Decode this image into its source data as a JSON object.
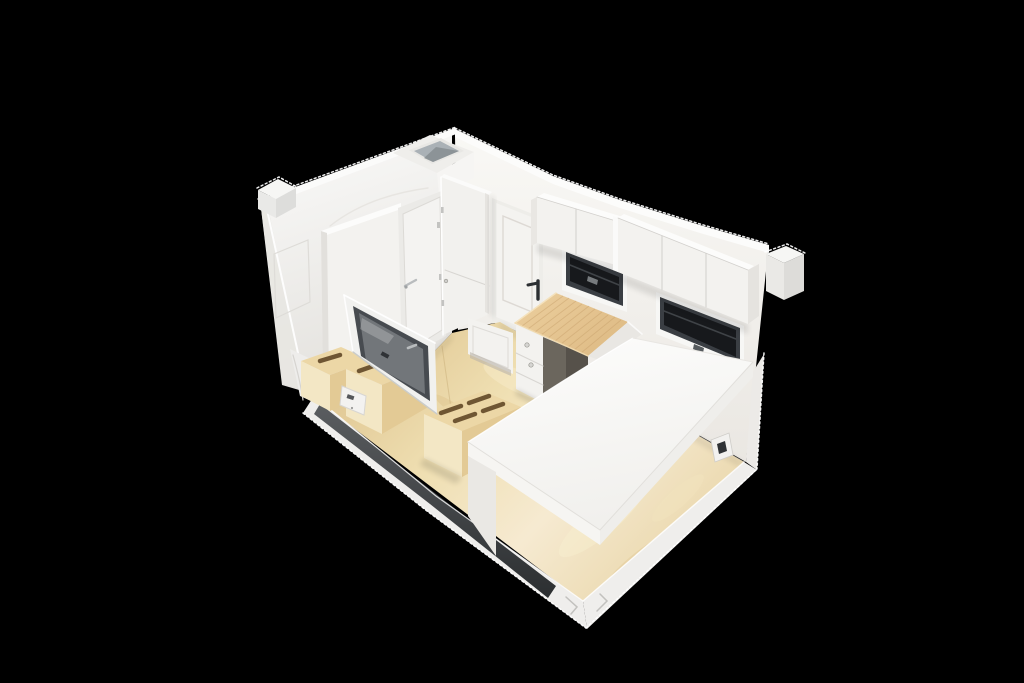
{
  "meta": {
    "type": "3d-architectural-render",
    "description": "High-angle isometric cutaway rendering of a compact container tiny-house studio interior floating on a pure black background",
    "camera": "elevated front-left three-quarter view"
  },
  "palette": {
    "background": "#000000",
    "wallBright": "#fbfbfa",
    "wallWhite": "#f4f3f0",
    "wallShade": "#e4e2de",
    "cabinetWhite": "#f3f2ef",
    "cabinetShade": "#e5e3df",
    "trimWhite": "#efeeec",
    "platformWhite": "#fbfbfa",
    "floorWood": "#eedcae",
    "floorWoodLight": "#f6ead1",
    "floorWoodDark": "#ddc28d",
    "stepWood": "#ecd7a6",
    "stepWoodFront": "#f3e7c5",
    "stepWoodSide": "#e3ca95",
    "slotBrown": "#6f5633",
    "deskWood": "#e5c492",
    "deskGrain": "#c9a26d",
    "windowGlass": "#17191c",
    "windowFrame": "#3a3e43",
    "sashGray": "#474b50",
    "paneReflect": "#d8dcdd",
    "trackCharcoal": "#2c2f31",
    "trackCharcoalLight": "#5a5d60",
    "skylightGray": "#aab1b6",
    "metalSilver": "#b9bcbe"
  },
  "scene": {
    "objects": [
      {
        "name": "bathroom-pod",
        "label": "Bathroom pod with rooftop vent opening"
      },
      {
        "name": "bathroom-door",
        "label": "Interior door with silver lever handle"
      },
      {
        "name": "wardrobe",
        "label": "Tall two-door wardrobe cabinet"
      },
      {
        "name": "entry-door",
        "label": "Entry door with black lever handle"
      },
      {
        "name": "upper-cabinets",
        "label": "Two banks of wall-hung slab-front cabinets"
      },
      {
        "name": "awning-windows",
        "label": "Two dark-framed awning windows in the right wall"
      },
      {
        "name": "desk",
        "label": "Butcher-block desk with drawer pedestal"
      },
      {
        "name": "bed-platform",
        "label": "Large white raised bed platform"
      },
      {
        "name": "storage-steps",
        "label": "Plywood storage step boxes with routed grip slots"
      },
      {
        "name": "side-window",
        "label": "Gray-framed glazed window unit on the left"
      },
      {
        "name": "floor",
        "label": "Light plywood floor"
      },
      {
        "name": "base-track",
        "label": "Charcoal floor track in white base trim"
      },
      {
        "name": "corner-fittings",
        "label": "Container corner castings"
      },
      {
        "name": "wall-switch",
        "label": "Small wall switch plate"
      },
      {
        "name": "outlet",
        "label": "Power outlet under platform"
      }
    ]
  }
}
